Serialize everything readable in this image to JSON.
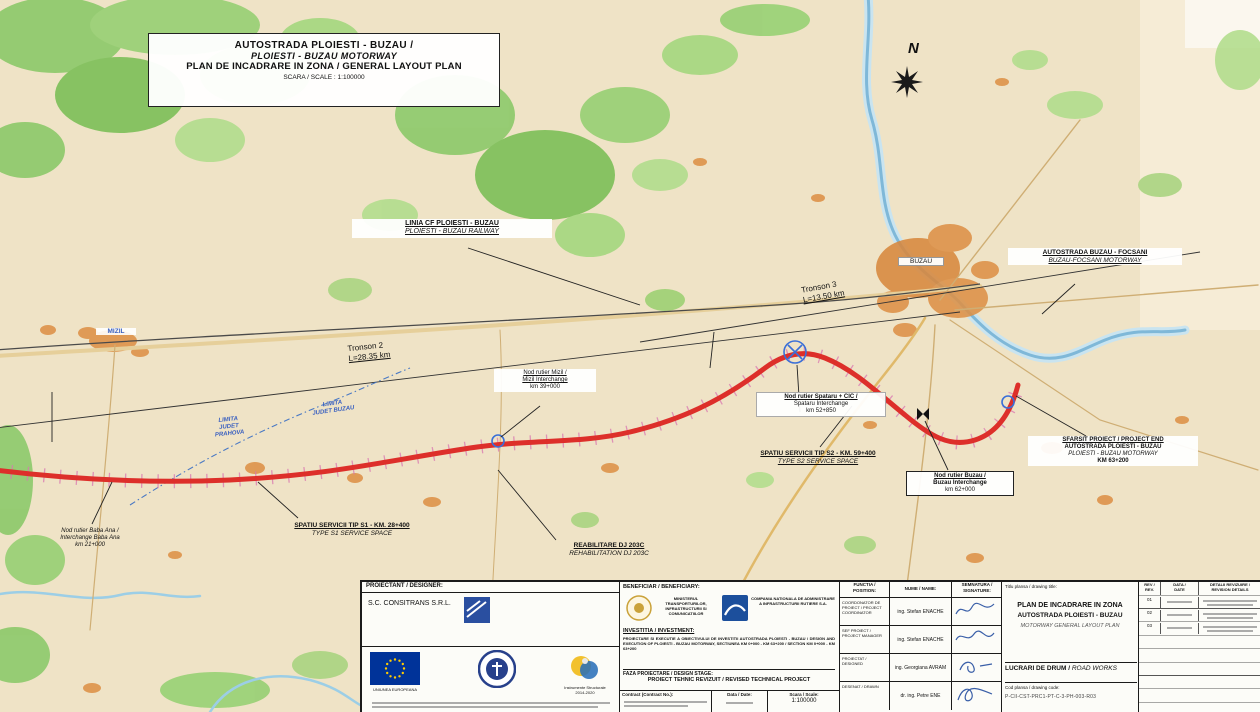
{
  "title_box": {
    "line1": "AUTOSTRADA PLOIESTI - BUZAU /",
    "line2": "PLOIESTI - BUZAU MOTORWAY",
    "line3": "PLAN DE INCADRARE IN ZONA / GENERAL LAYOUT PLAN",
    "line4": "SCARA / SCALE : 1:100000"
  },
  "compass": {
    "north": "N"
  },
  "cities": {
    "mizil": "MIZIL",
    "buzau": "BUZAU"
  },
  "county": {
    "prahova": [
      "LIMITA",
      "JUDET",
      "PRAHOVA"
    ],
    "buzau": [
      "LIMITA",
      "JUDET BUZAU"
    ]
  },
  "sections": {
    "t2a": "Tronson 2",
    "t2b": "L=28.35 km",
    "t3a": "Tronson 3",
    "t3b": "L=13.50 km"
  },
  "callouts": {
    "railway": [
      "LINIA CF PLOIESTI - BUZAU",
      "PLOIESTI - BUZAU RAILWAY"
    ],
    "focsani": [
      "AUTOSTRADA BUZAU - FOCSANI",
      "BUZAU-FOCSANI MOTORWAY"
    ],
    "mizil_ic": [
      "Nod rutier Mizil /",
      "Mizil Interchange",
      "km 39+000"
    ],
    "spataru_ic": [
      "Nod rutier Spataru + CIC /",
      "Spataru Interchange",
      "km 52+850"
    ],
    "s2": [
      "SPATIU SERVICII TIP S2 - KM. 59+400",
      "TYPE S2 SERVICE SPACE"
    ],
    "buzau_ic": [
      "Nod rutier Buzau /",
      "Buzau Interchange",
      "km 62+000"
    ],
    "end": [
      "SFARSIT PROIECT / PROJECT END",
      "AUTOSTRADA PLOIESTI - BUZAU",
      "PLOIESTI - BUZAU MOTORWAY",
      "KM 63+200"
    ],
    "baba_ana": [
      "Nod rutier Baba Ana /",
      "Interchange Baba Ana",
      "km 21+000"
    ],
    "s1": [
      "SPATIU SERVICII TIP S1 - KM. 28+400",
      "TYPE S1 SERVICE SPACE"
    ],
    "dj203c": [
      "REABILITARE DJ 203C",
      "REHABILITATION DJ 203C"
    ]
  },
  "titleblock": {
    "designer": {
      "header": "PROIECTANT / DESIGNER:",
      "company": "S.C. CONSITRANS S.R.L.",
      "eu_caption": "UNIUNEA EUROPEANA",
      "is_caption": "Instrumente Structurale",
      "is_caption2": "2014-2020"
    },
    "beneficiary": {
      "header": "BENEFICIAR / BENEFICIARY:",
      "mt": "MINISTERUL TRANSPORTURILOR, INFRASTRUCTURII SI COMUNICATIILOR",
      "cnair": "COMPANIA NATIONALA DE ADMINISTRARE A INFRASTRUCTURII RUTIERE S.A.",
      "inv_label": "INVESTITIA / INVESTMENT:",
      "inv_text": "PROIECTARE SI EXECUTIE A OBIECTIVULUI DE INVESTITII AUTOSTRADA PLOIESTI - BUZAU / DESIGN AND EXECUTION OF PLOIESTI - BUZAU MOTORWAY, SECTIUNEA KM 0+000 - KM 63+200 / SECTION KM 0+000 - KM 63+200",
      "stage_label": "FAZA PROIECTARE / DESIGN STAGE:",
      "stage_value": "PROIECT TEHNIC REVIZUIT / REVISED TECHNICAL PROJECT",
      "contract_label": "Contract (Contract No.):",
      "date_label": "Data / Date:",
      "scale_label": "Scara / Scale:",
      "scale_value": "1:100000"
    },
    "signatures": {
      "col_position": "FUNCTIA /",
      "col_position2": "POSITION:",
      "col_name": "NUME / NAME:",
      "col_sig": "SEMNATURA /",
      "col_sig2": "SIGNATURE:",
      "rows": [
        {
          "position": "COORDONATOR DE PROIECT / PROJECT COORDINATOR",
          "name": "ing. Stefan ENACHE"
        },
        {
          "position": "SEF PROIECT / PROJECT MANAGER",
          "name": "ing. Stefan ENACHE"
        },
        {
          "position": "PROIECTAT / DESIGNED",
          "name": "ing. Georgiana AVRAM"
        },
        {
          "position": "DESENAT / DRAWN",
          "name": "dr. ing. Petre ENE"
        }
      ]
    },
    "drawing": {
      "title_label": "Titlu plansa / drawing title:",
      "t1": "PLAN DE INCADRARE IN ZONA",
      "t2": "AUTOSTRADA PLOIESTI - BUZAU",
      "t3": "MOTORWAY GENERAL LAYOUT PLAN",
      "rev_col": "REV /",
      "rev_col2": "REV.",
      "date_col": "DATA /",
      "date_col2": "DATE",
      "det_col": "DETALII REVIZUIRE /",
      "det_col2": "REVISION DETAILS",
      "revisions": [
        "01",
        "02",
        "03"
      ],
      "works": "LUCRARI DE DRUM /",
      "works_en": "ROAD WORKS",
      "code_label": "Cod plansa / drawing code:",
      "code_value": "P-CII-CST-PRC1-PT-C-3-PH-003-R03"
    }
  }
}
